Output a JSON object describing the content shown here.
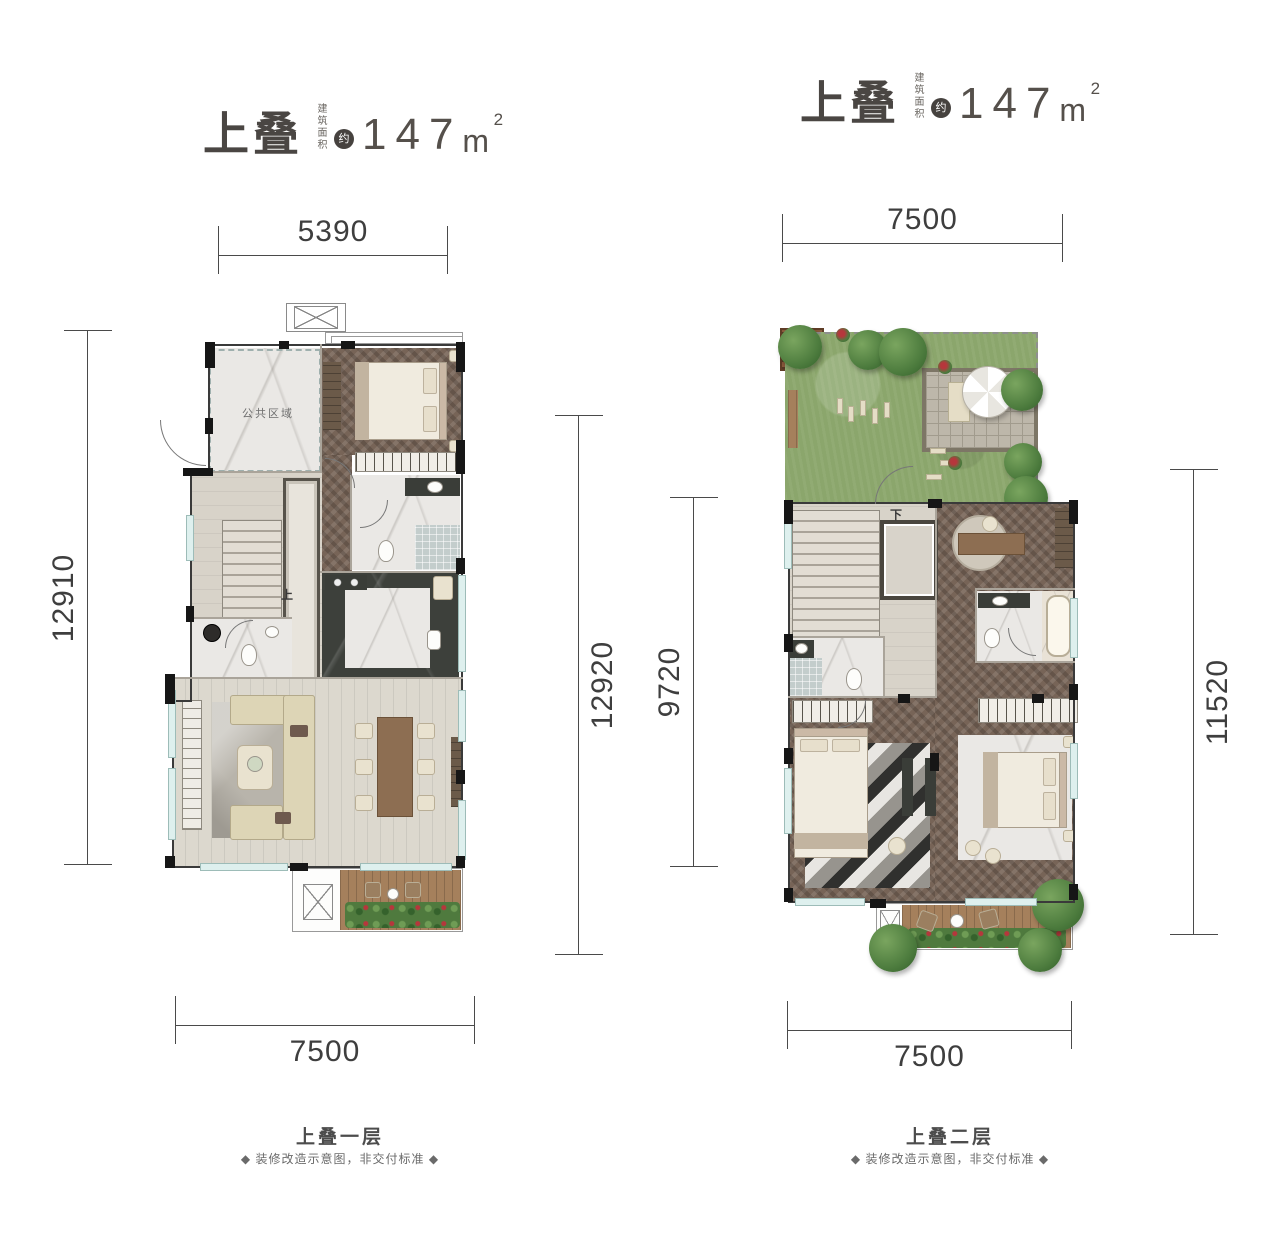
{
  "colors": {
    "wall": "#1b1b1b",
    "window_glass": "#def0ee",
    "lawn_green": "#8ba66c",
    "wood_dark": "#776457",
    "text_dark": "#3e3e3e"
  },
  "plans": [
    {
      "caption": "上叠一层",
      "note": "◆ 装修改造示意图，非交付标准 ◆",
      "title": {
        "main": "上叠",
        "area_label": "建筑面积",
        "approx": "约",
        "value": "147",
        "unit": "m",
        "exponent": "2"
      },
      "dims": {
        "top": "5390",
        "left": "12910",
        "right": "12920",
        "bottom": "7500"
      },
      "labels": {
        "room": "公共区域",
        "stair": "上"
      }
    },
    {
      "caption": "上叠二层",
      "note": "◆ 装修改造示意图，非交付标准 ◆",
      "title": {
        "main": "上叠",
        "area_label": "建筑面积",
        "approx": "约",
        "value": "147",
        "unit": "m",
        "exponent": "2"
      },
      "dims": {
        "top": "7500",
        "left": "9720",
        "right": "11520",
        "bottom": "7500"
      },
      "labels": {
        "stair": "下"
      }
    }
  ]
}
